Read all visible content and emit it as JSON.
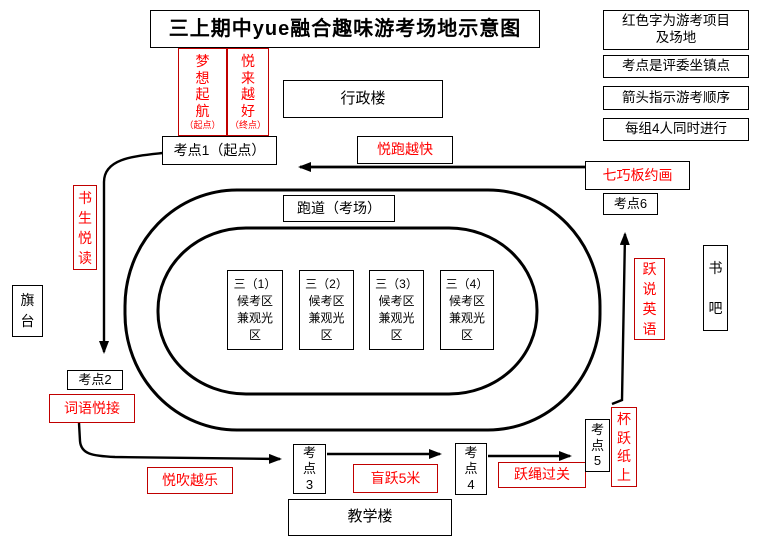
{
  "title": "三上期中yue融合趣味游考场地示意图",
  "legend": {
    "item1": "红色字为游考项目\n及场地",
    "item2": "考点是评委坐镇点",
    "item3": "箭头指示游考顺序",
    "item4": "每组4人同时进行"
  },
  "buildings": {
    "admin": "行政楼",
    "teaching": "教学楼",
    "track_label": "跑道（考场）",
    "flag_stand": "旗\n台",
    "book_bar": "书\n吧"
  },
  "checkpoints": {
    "cp1": "考点1（起点）",
    "cp2": "考点2",
    "cp3": "考\n点\n3",
    "cp4": "考\n点\n4",
    "cp5": "考\n点\n5",
    "cp6": "考点6"
  },
  "projects": {
    "dream_sail": "梦\n想\n起\n航",
    "dream_sail_note": "（起点）",
    "better_better": "悦\n来\n越\n好",
    "better_better_note": "（终点）",
    "run_fast": "悦跑越快",
    "tangram_draw": "七巧板约画",
    "speak_english": "跃\n说\n英\n语",
    "scholar_reading": "书\n生\n悦\n读",
    "word_relay": "词语悦接",
    "blow_music": "悦吹越乐",
    "blind_jump": "盲跃5米",
    "rope_skip": "跃绳过关",
    "cup_on_paper": "杯\n跃\n纸\n上"
  },
  "waiting_areas": [
    "三（1）\n候考区\n兼观光\n区",
    "三（2）\n候考区\n兼观光\n区",
    "三（3）\n候考区\n兼观光\n区",
    "三（4）\n候考区\n兼观光\n区"
  ],
  "colors": {
    "red_text": "#ff0000",
    "red_border": "#c00000",
    "line": "#000000"
  }
}
